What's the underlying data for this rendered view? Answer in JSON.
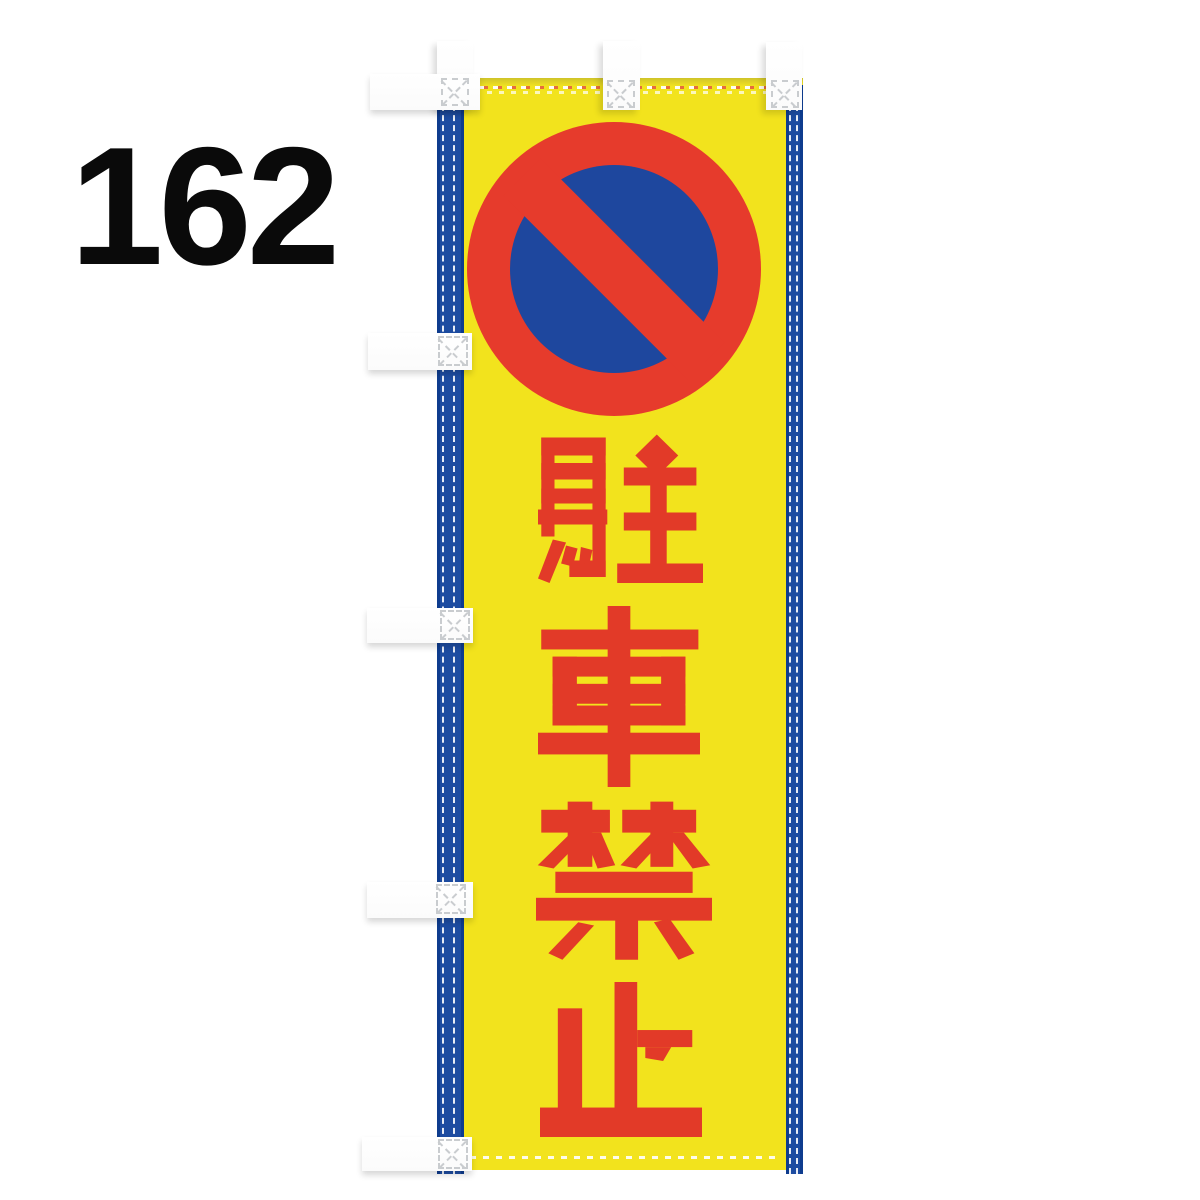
{
  "page": {
    "background_color": "#ffffff"
  },
  "item_number": {
    "label": "162"
  },
  "banner": {
    "text": "駐車禁止",
    "characters": [
      "駐",
      "車",
      "禁",
      "止"
    ],
    "text_orientation": "vertical",
    "sign": {
      "icon": "no-parking-icon"
    },
    "tabs": {
      "top_count": 3,
      "side_count": 5
    },
    "colors": {
      "fabric_yellow": "#f2e31d",
      "text_red": "#e23a28",
      "sign_ring_red": "#e63b2c",
      "sign_circle_blue": "#1e479e",
      "edge_band_blue": "#1d4ca1",
      "tab_white": "#ffffff"
    }
  }
}
